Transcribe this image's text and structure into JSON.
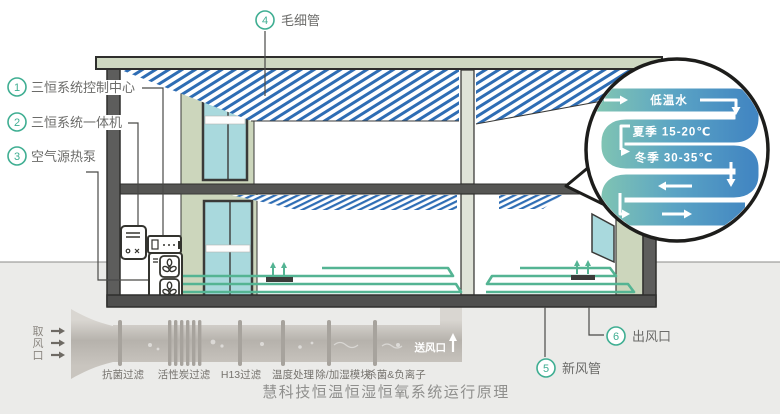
{
  "title": "慧科技恒温恒湿恒氧系统运行原理",
  "callouts": [
    {
      "num": "1",
      "label": "三恒系统控制中心"
    },
    {
      "num": "2",
      "label": "三恒系统一体机"
    },
    {
      "num": "3",
      "label": "空气源热泵"
    },
    {
      "num": "4",
      "label": "毛细管"
    },
    {
      "num": "5",
      "label": "新风管"
    },
    {
      "num": "6",
      "label": "出风口"
    }
  ],
  "magnifier": {
    "flow": "低温水",
    "summer": "夏季 15-20℃",
    "winter": "冬季 30-35℃"
  },
  "duct": {
    "intake": "取风口",
    "intake_chars": [
      "取",
      "风",
      "口"
    ],
    "outlet": "送风口",
    "stages": [
      "抗菌过滤",
      "活性炭过滤",
      "H13过滤",
      "温度处理",
      "除/加湿模块",
      "杀菌&负离子"
    ]
  },
  "colors": {
    "accent": "#3fae92",
    "capillary_blue": "#2e6db4",
    "wall_green": "#ccd6bc",
    "glass": "#a9d9dd",
    "pipe_teal": "#82c6b2",
    "pipe_blue": "#4286c2",
    "coil_green": "#54b493"
  }
}
